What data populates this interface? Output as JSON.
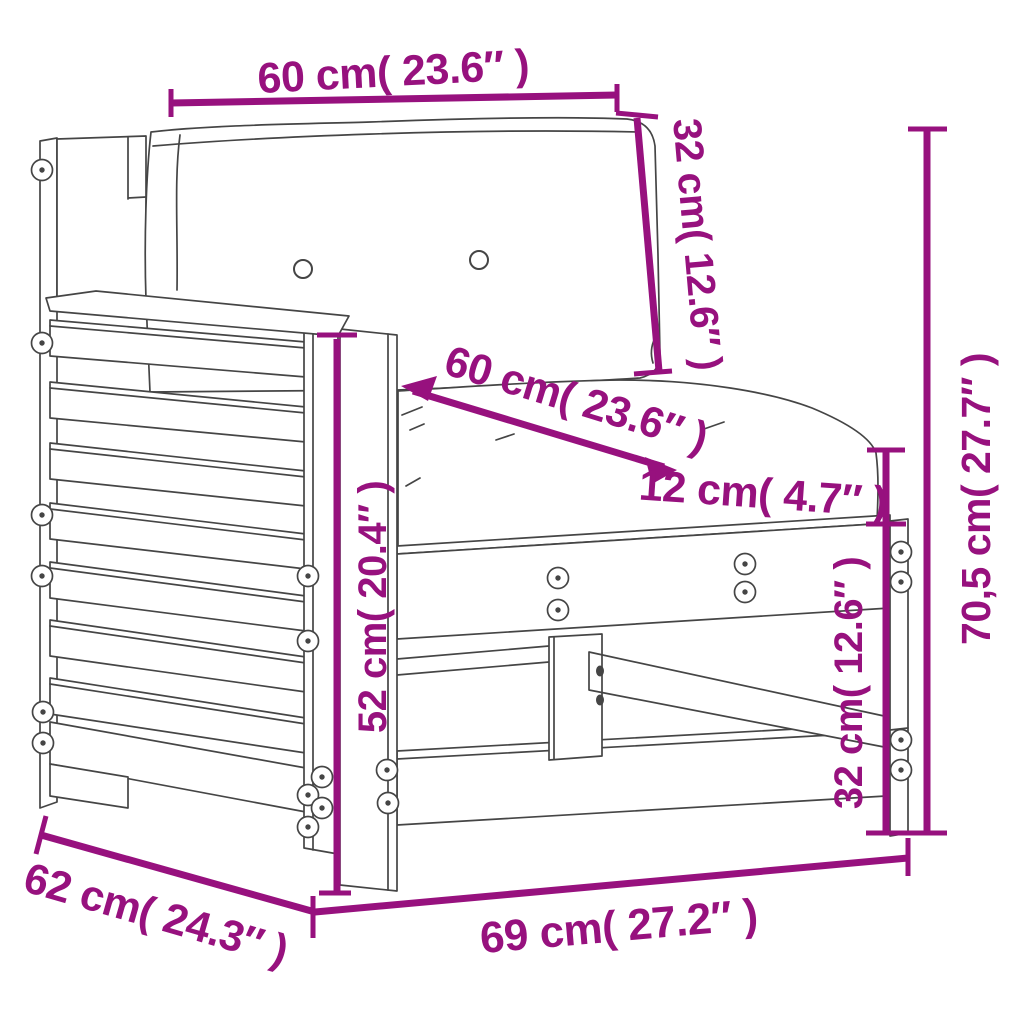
{
  "diagram": {
    "type": "product-dimension-diagram",
    "subject": "garden sofa armrest section with cushions",
    "colors": {
      "dimension": "#97117e",
      "line": "#454545",
      "background": "#ffffff"
    },
    "labels": {
      "back_cushion_width": "60 cm( 23.6″ )",
      "back_cushion_height": "32 cm( 12.6″ )",
      "seat_cushion_width": "60 cm( 23.6″ )",
      "seat_cushion_thickness": "12 cm( 4.7″ )",
      "overall_height": "70,5 cm( 27.7″ )",
      "armrest_height": "52 cm( 20.4″ )",
      "seat_frame_height": "32 cm( 12.6″ )",
      "overall_depth": "62 cm( 24.3″ )",
      "overall_width": "69 cm( 27.2″ )"
    }
  }
}
